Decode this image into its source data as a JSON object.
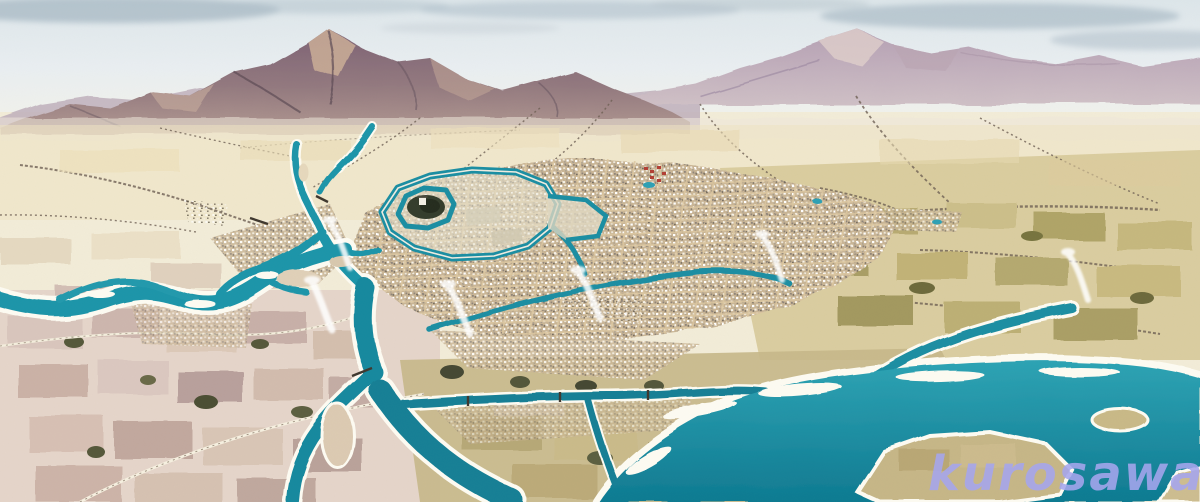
{
  "watermark": {
    "text": "kurosawa",
    "color": "#a6a6ee"
  },
  "scene": {
    "description": "Watercolor bird's-eye panorama of a moated castle town on a river plain, mountains along the horizon, tributary rivers converging west of the castle and a broad teal river sweeping across the lower right, farmland patchwork all around and smoke plumes rising from the town.",
    "regions": [
      "sky",
      "mountain-ranges",
      "distant-plain",
      "radiating-village-roads",
      "farmland-patchwork",
      "river-network",
      "castle-with-moats",
      "castle-town-grid",
      "smoke-plumes",
      "watermark"
    ]
  },
  "palette": {
    "sky": "#e9eef1",
    "cloud": "#a9bac6",
    "mountain_dark": "#86687a",
    "mountain_mid": "#a08a92",
    "mountain_light": "#c7b6c4",
    "mountain_sunlit": "#cbae98",
    "plain_cream": "#f2ecd8",
    "plain_tint": "#ecdfba",
    "field_pink": "#e3d3c9",
    "field_mauve": "#c3aaa4",
    "field_olive": "#d6c897",
    "field_olive_dark": "#a59a62",
    "tree_green": "#55583a",
    "river_teal": "#1e95a9",
    "river_deep": "#0f7c92",
    "sandbank": "#fdfbf2",
    "city_ground": "#cdb997",
    "city_street": "#dcc7a0",
    "castle_wall": "#e8e3d1",
    "castle_trees": "#343d2c",
    "temple_red": "#b23f35",
    "village_road": "#6e6054",
    "smoke": "#ffffff"
  }
}
